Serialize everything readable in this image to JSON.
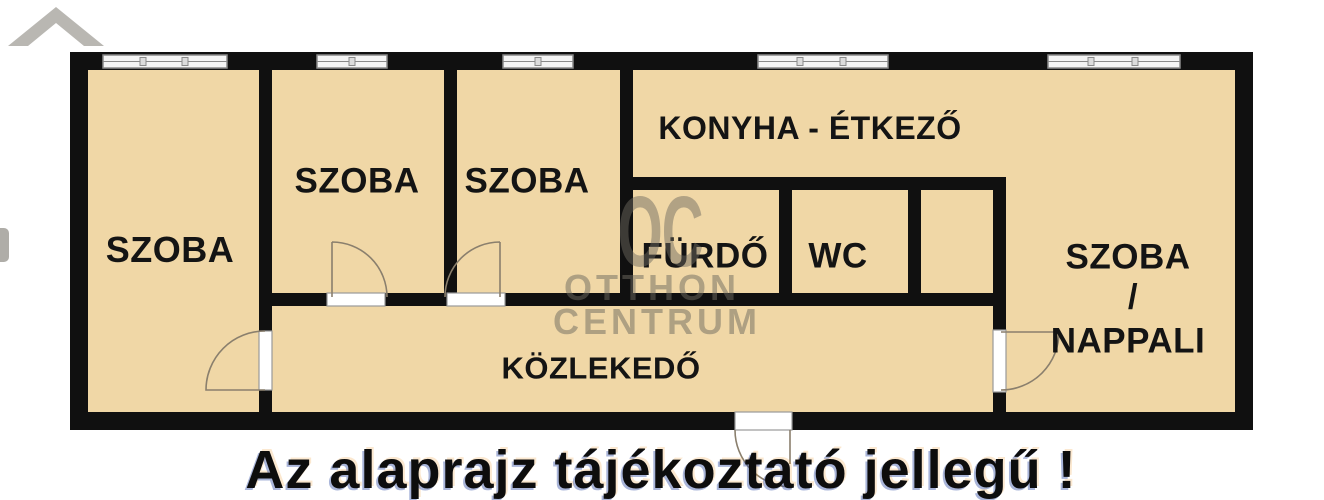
{
  "floorplan": {
    "rooms": {
      "szoba_left": "SZOBA",
      "szoba_2": "SZOBA",
      "szoba_3": "SZOBA",
      "konyha_etkezo": "KONYHA - ÉTKEZŐ",
      "furdo": "FÜRDŐ",
      "wc": "WC",
      "szoba_nappali_line1": "SZOBA",
      "szoba_nappali_line2": "/",
      "szoba_nappali_line3": "NAPPALI",
      "kozlekedo": "KÖZLEKEDŐ"
    },
    "watermark": {
      "monogram": "OC",
      "line1": "OTTHON",
      "line2": "CENTRUM"
    },
    "caption": "Az alaprajz tájékoztató jellegű !",
    "colors": {
      "floor": "#f0d7a6",
      "wall": "#101010",
      "window_fill": "#f4f4f4",
      "window_border": "#8a8a8a",
      "watermark": "#6e6a60",
      "door_line": "#8a7f6d"
    }
  }
}
